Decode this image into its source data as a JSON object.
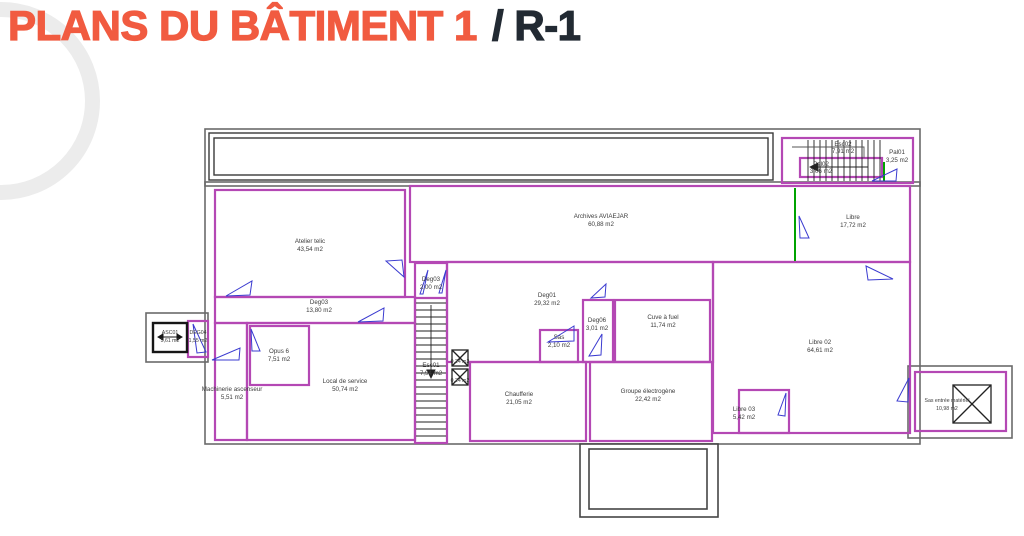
{
  "title": {
    "main": "PLANS DU BÂTIMENT 1",
    "suffix": "/ R-1"
  },
  "plan": {
    "rooms": [
      {
        "name": "Atelier telic",
        "area": "43,54 m2"
      },
      {
        "name": "Archives AVIAEJAR",
        "area": "60,88 m2"
      },
      {
        "name": "Libre",
        "area": "17,72 m2"
      },
      {
        "name": "Esc02",
        "area": "7,91 m2"
      },
      {
        "name": "Pal02",
        "area": "3,06 m2"
      },
      {
        "name": "Pal01",
        "area": "3,25 m2"
      },
      {
        "name": "Deg03",
        "area": "13,80 m2"
      },
      {
        "name": "Deg03",
        "area": "2,00 m2"
      },
      {
        "name": "Esc01",
        "area": "7,94 m2"
      },
      {
        "name": "Deg01",
        "area": "29,32 m2"
      },
      {
        "name": "Sas",
        "area": "2,10 m2"
      },
      {
        "name": "Deg06",
        "area": "3,01 m2"
      },
      {
        "name": "Cuve à fuel",
        "area": "11,74 m2"
      },
      {
        "name": "Libre 02",
        "area": "64,61 m2"
      },
      {
        "name": "Libre 03",
        "area": "5,42 m2"
      },
      {
        "name": "Local de service",
        "area": "50,74 m2"
      },
      {
        "name": "Opus 6",
        "area": "7,51 m2"
      },
      {
        "name": "Machinerie ascenseur",
        "area": "5,51 m2"
      },
      {
        "name": "Chaufferie",
        "area": "21,05 m2"
      },
      {
        "name": "Groupe électrogène",
        "area": "22,42 m2"
      },
      {
        "name": "Sas entrée matériel",
        "area": "10,98 m2"
      },
      {
        "name": "ASC01",
        "area": "5,61 m2"
      },
      {
        "name": "DEG04",
        "area": "1,55 m2"
      }
    ],
    "shafts": [
      {
        "area": "0,24 m2"
      },
      {
        "area": "0,24 m2"
      }
    ]
  },
  "colors": {
    "title_accent": "#f15b40",
    "title_dark": "#222a33",
    "wall_magenta": "#b448b4",
    "outer_wall_gray": "#6a6a6a",
    "door_blue": "#3b3bd0",
    "partition_green": "#00a300",
    "watermark_gray": "#ececec"
  }
}
